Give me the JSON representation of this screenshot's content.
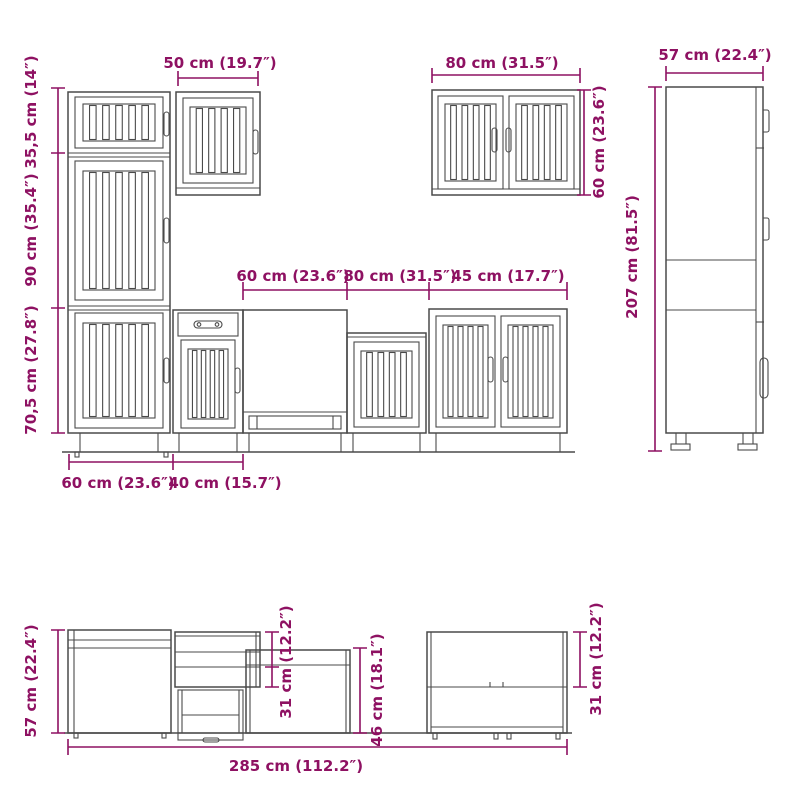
{
  "colors": {
    "dimension": "#8e1162",
    "drawing_line": "#4a4a4a",
    "background": "#ffffff"
  },
  "front_view": {
    "tall_unit": {
      "width_top": "50 cm (19.7″)",
      "height_top": "35,5 cm (14″)",
      "height_middle": "90 cm (35.4″)",
      "height_bottom": "70,5 cm (27.8″)",
      "width_bottom_left": "60 cm (23.6″)",
      "width_bottom_right": "40 cm (15.7″)"
    },
    "base_row": {
      "width_left": "60 cm (23.6″)",
      "width_middle": "80 cm (31.5″)",
      "width_right": "45 cm (17.7″)"
    },
    "wall_cabinet": {
      "width": "80 cm (31.5″)",
      "height": "60 cm (23.6″)"
    }
  },
  "side_view": {
    "width": "57 cm (22.4″)",
    "height": "207 cm (81.5″)"
  },
  "profile_view": {
    "height_left": "57 cm (22.4″)",
    "upper_depth": "31 cm (12.2″)",
    "mid_height": "46 cm (18.1″)",
    "right_depth": "31 cm (12.2″)",
    "total_length": "285 cm (112.2″)"
  }
}
